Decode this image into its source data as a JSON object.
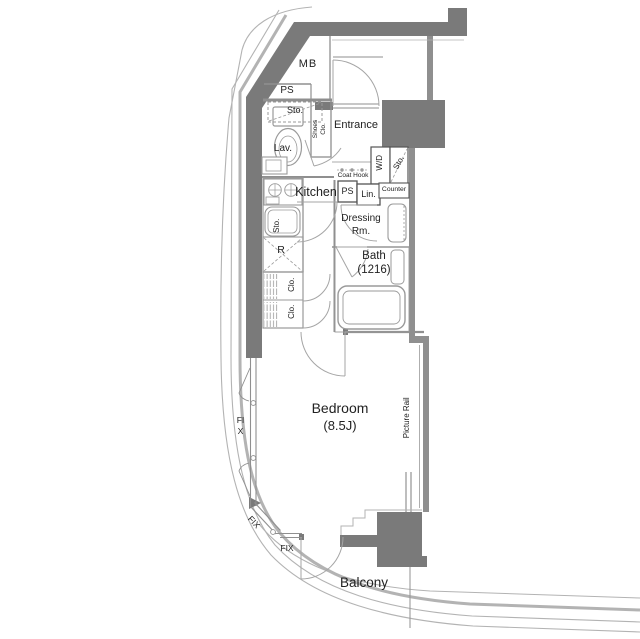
{
  "labels": {
    "mb": "MB",
    "ps_top": "PS",
    "lav_storage": "Sto.",
    "lav": "Lav.",
    "shoes_closet": [
      "Shoes",
      "Clo."
    ],
    "entrance": "Entrance",
    "washer_dryer": "W/D",
    "entry_storage": "Sto.",
    "coat_hook": "Coat Hook",
    "kitchen": "Kitchen",
    "ps_mid": "PS",
    "linen": "Lin.",
    "counter": "Counter",
    "dressing_room": [
      "Dressing",
      "Rm."
    ],
    "bath": [
      "Bath",
      "(1216)"
    ],
    "kitchen_storage": "Sto.",
    "refrigerator": "R",
    "closet_upper": "Clo.",
    "closet_lower": "Clo.",
    "bedroom": [
      "Bedroom",
      "(8.5J)"
    ],
    "picture_rail": "Picture Rail",
    "fix_window_left": "FIX",
    "fix_window_diagonal": "FIX",
    "fix_window_bottom": "FIX",
    "balcony": "Balcony"
  },
  "colors": {
    "structure": "#7a7a7a",
    "wall": "#8f8f8f",
    "exterior": "#b3b3b3",
    "fixture": "#9a9a9a",
    "door": "#a5a5a5",
    "text": "#222222",
    "background": "#ffffff"
  }
}
